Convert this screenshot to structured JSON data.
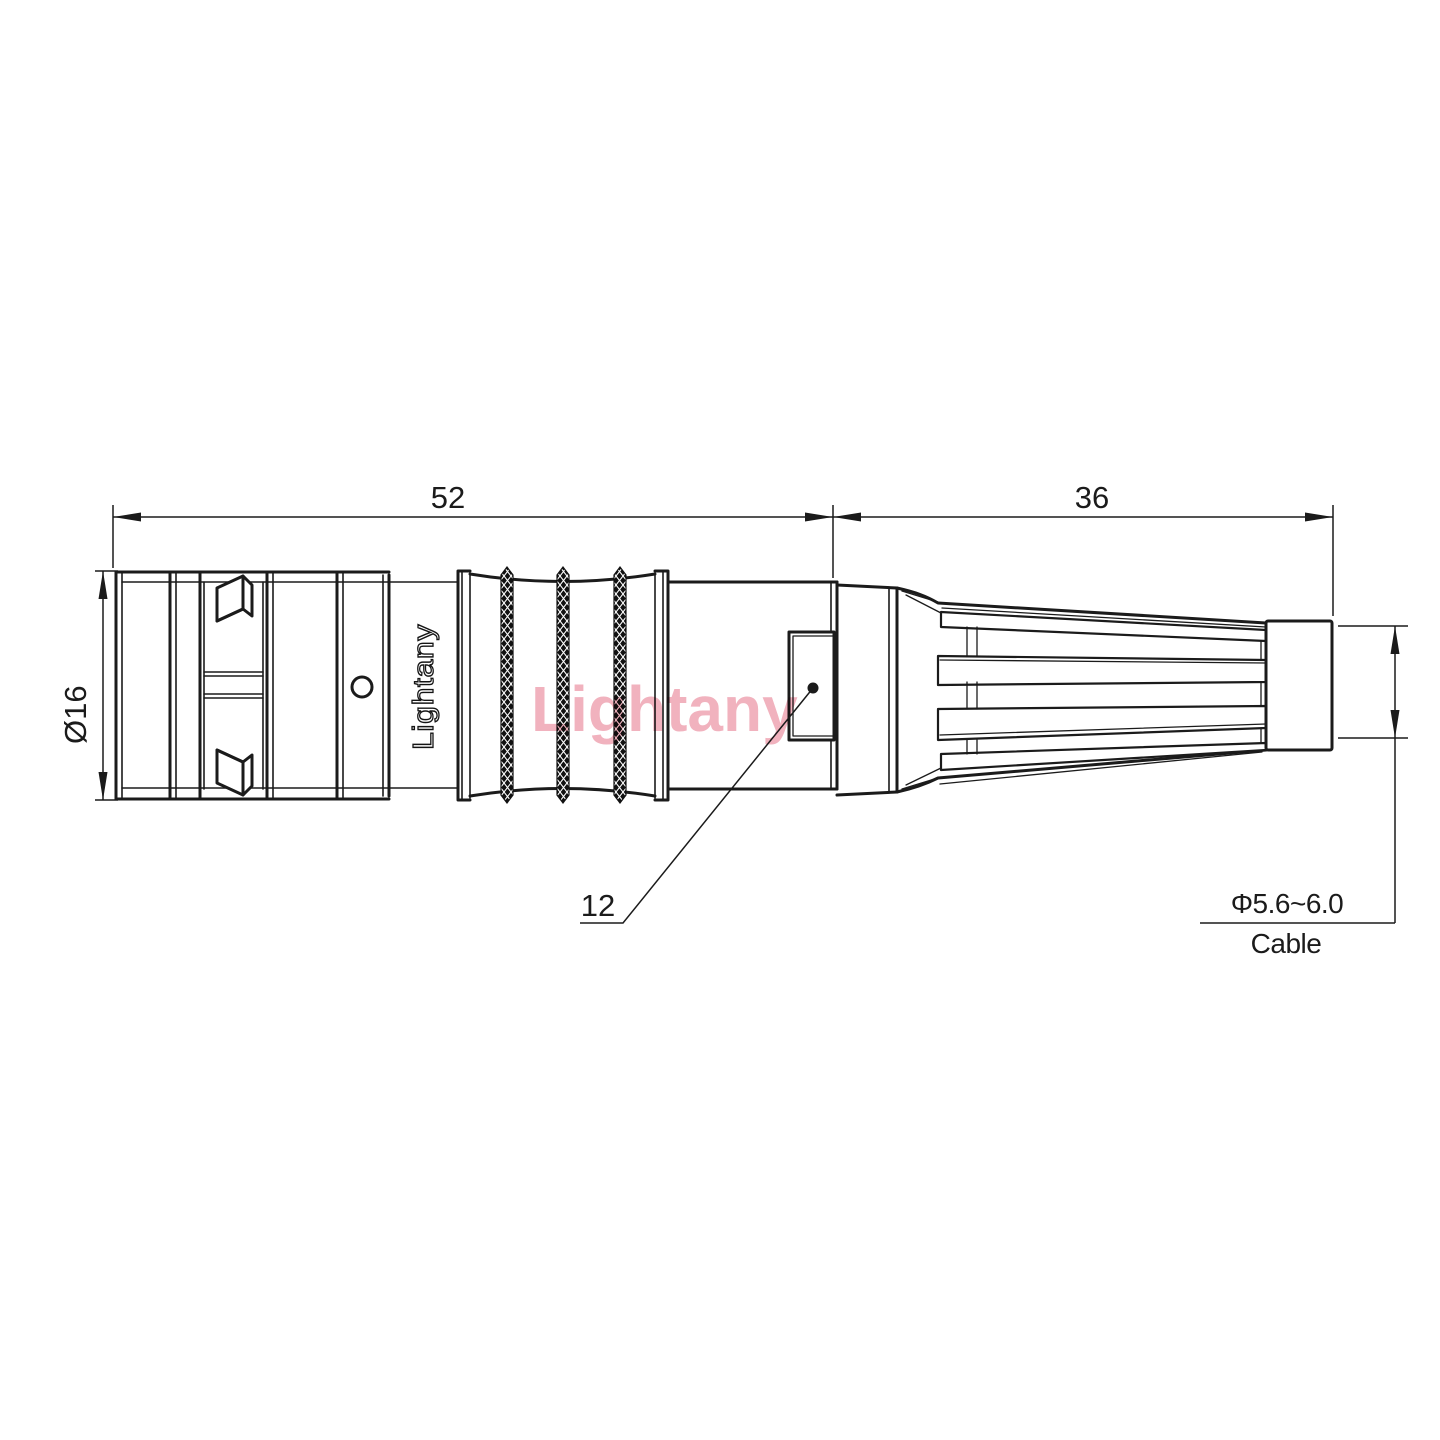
{
  "drawing": {
    "dim_52": "52",
    "dim_36": "36",
    "dim_diameter": "Ø16",
    "dim_12": "12",
    "cable_spec": "Φ5.6~6.0",
    "cable_label": "Cable",
    "part_label": "Lightany",
    "watermark": "Lightany",
    "colors": {
      "line": "#1b1b1b",
      "watermark_pink": "#ee9fae",
      "background": "#ffffff"
    }
  }
}
